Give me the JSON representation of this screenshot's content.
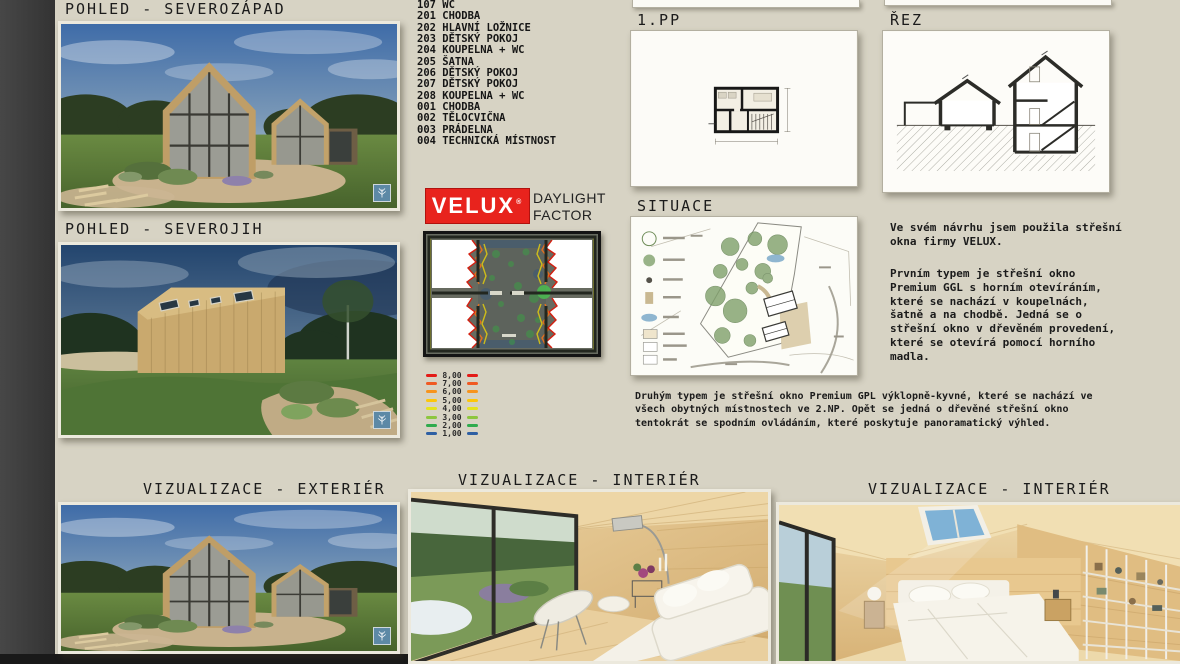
{
  "board": {
    "colors": {
      "background": "#d7d3c4",
      "edge_strip": "#3c3c3c",
      "velux_red": "#e8231d",
      "heading_text": "#1b1b1b"
    },
    "headings": {
      "pohled_severozapad": "POHLED - SEVEROZÁPAD",
      "pohled_severojih": "POHLED - SEVEROJIH",
      "plan_1pp": "1.PP",
      "rez": "ŘEZ",
      "situace": "SITUACE",
      "viz_exterier": "VIZUALIZACE - EXTERIÉR",
      "viz_interier_mid": "VIZUALIZACE - INTERIÉR",
      "viz_interier_right": "VIZUALIZACE - INTERIÉR"
    },
    "room_list": [
      "107 WC",
      "201 CHODBA",
      "202 HLAVNÍ LOŽNICE",
      "203 DĚTSKÝ POKOJ",
      "204 KOUPELNA + WC",
      "205 ŠATNA",
      "206 DĚTSKÝ POKOJ",
      "207 DĚTSKÝ POKOJ",
      "208 KOUPELNA + WC",
      "001 CHODBA",
      "002 TĚLOCVIČNA",
      "003 PRÁDELNA",
      "004 TECHNICKÁ MÍSTNOST"
    ],
    "velux_logo": {
      "text": "VELUX",
      "reg": "®"
    },
    "daylight_caption": "DAYLIGHT\nFACTOR",
    "daylight_legend": [
      {
        "value": "8,00",
        "color": "#e31b17"
      },
      {
        "value": "7,00",
        "color": "#f05a23"
      },
      {
        "value": "6,00",
        "color": "#f7941d"
      },
      {
        "value": "5,00",
        "color": "#fdc60b"
      },
      {
        "value": "4,00",
        "color": "#e6e31d"
      },
      {
        "value": "3,00",
        "color": "#8dc63f"
      },
      {
        "value": "2,00",
        "color": "#2fab4e"
      },
      {
        "value": "1,00",
        "color": "#2e5fa3"
      }
    ],
    "text_blocks": {
      "intro": "Ve svém návrhu jsem použila střešní\nokna firmy VELUX.",
      "type1": "Prvním typem je střešní okno\nPremium GGL s horním otevíráním,\nkteré se nachází v koupelnách,\nšatně a na chodbě. Jedná se o\nstřešní okno v dřevěném provedení,\nkteré se otevírá pomocí horního\nmadla.",
      "type2": "Druhým typem je střešní okno Premium GPL výklopně-kyvné, které se nachází ve\nvšech obytných místnostech ve 2.NP. Opět se jedná o dřevěné střešní okno\ntentokrát se spodním ovládáním, které poskytuje panoramatický výhled."
    },
    "icons": {
      "render_watermark": "lumion-tree-logo"
    }
  }
}
